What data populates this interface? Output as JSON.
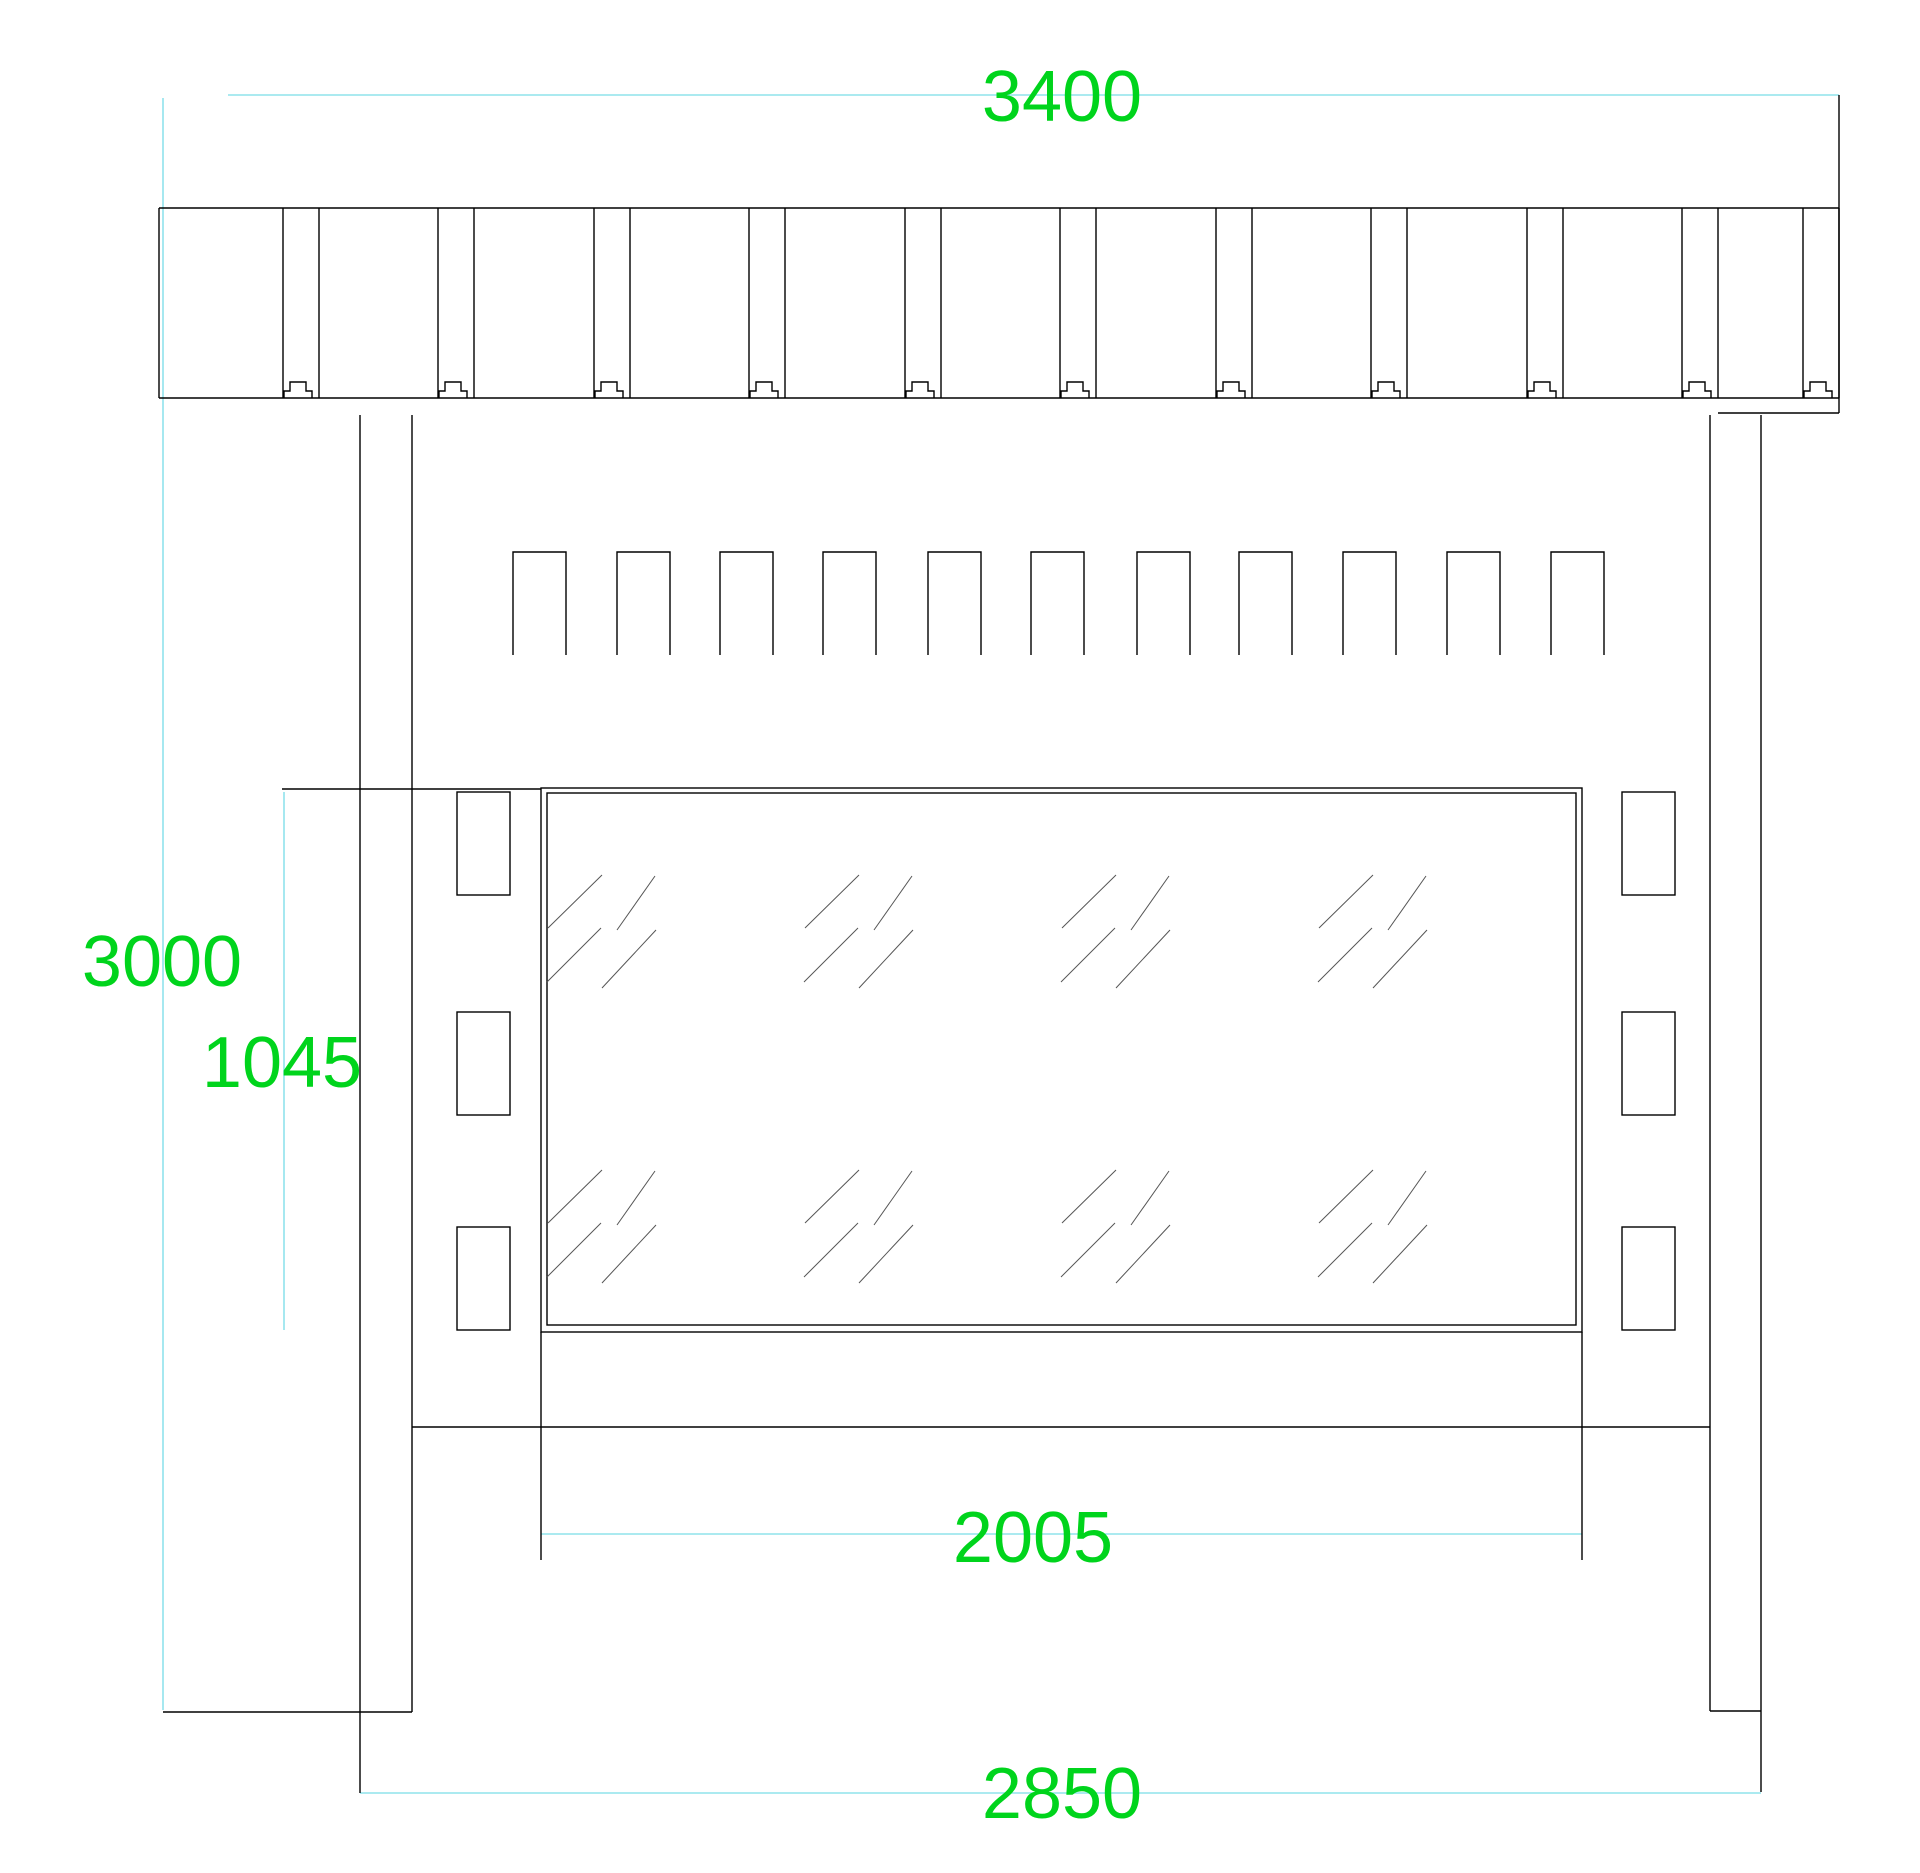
{
  "drawing": {
    "dimension_labels": {
      "width_top": "3400",
      "height_overall": "3000",
      "glass_height": "1045",
      "glass_width": "2005",
      "width_bottom": "2850"
    },
    "colors": {
      "background": "#ffffff",
      "drawing_line": "#000000",
      "hatch_line": "#555555",
      "extension_line": "#8fe3ec",
      "dimension_text": "#00d41c"
    }
  }
}
